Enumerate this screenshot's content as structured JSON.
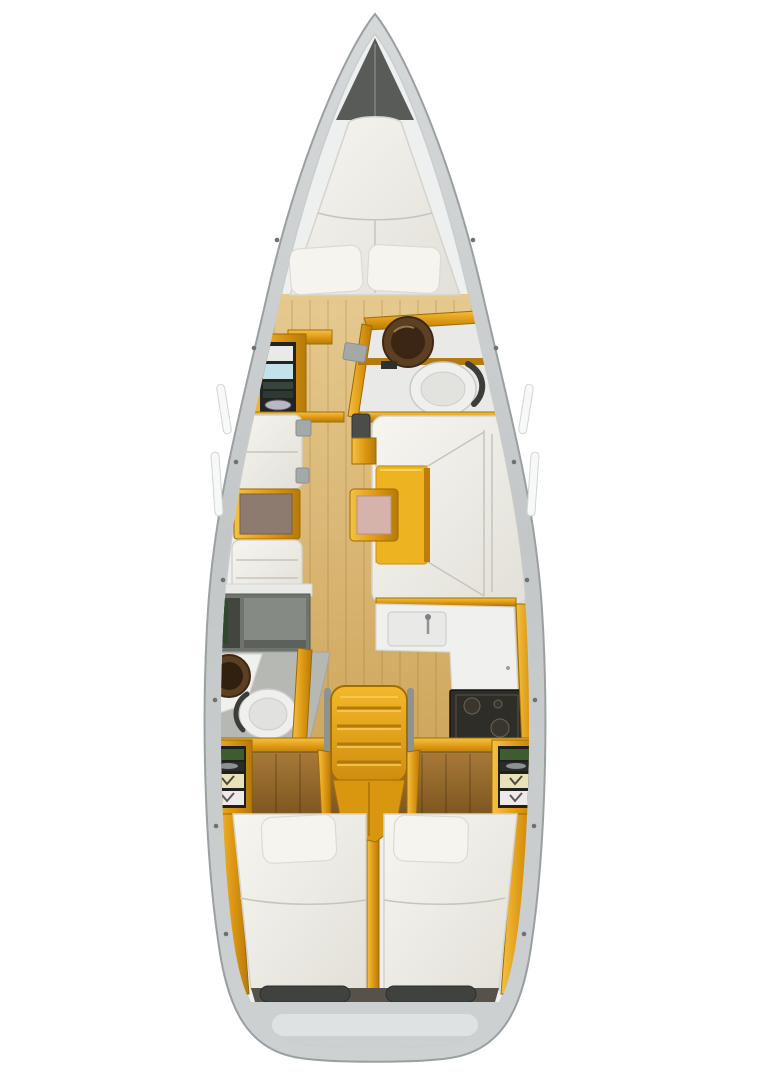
{
  "page": {
    "background": "#ffffff",
    "content_type": "sailing-yacht-interior-deck-plan",
    "view": "top-down"
  },
  "palette": {
    "background": "#ffffff",
    "hull_edge": "#9aa0a1",
    "hull_inner": "#eef0f0",
    "bow_shadow": "#585b58",
    "wood": "#e8a716",
    "wood_light": "#f3c340",
    "wood_dark": "#a36d08",
    "headboard_wood": "#96682a",
    "floor": "#d9b873",
    "cushion": "#f0eee7",
    "cushion_shadow": "#d5d3cb",
    "table_brown": "#8d7b70",
    "table_yellow": "#edb320",
    "stool_pink": "#d5b2aa",
    "counter_white": "#f0f1ef",
    "fixture_white": "#eff0ee",
    "sink_bronze": "#5d3f22",
    "stove_black": "#2e2d28",
    "shower_gray": "#70746f",
    "locker_dark": "#1e201c",
    "shelf_green": "#3e5c30",
    "shelf_cream": "#e9e1b9",
    "transom_gray": "#ccd0d0",
    "recess_dark": "#3f423f"
  },
  "plan": {
    "vessel": "monohull-sailing-yacht",
    "areas": [
      {
        "name": "bow",
        "fixtures": [
          "anchor-locker"
        ]
      },
      {
        "name": "forward-cabin",
        "fixtures": [
          "v-berth-double-mattress",
          "pillow-port",
          "pillow-starboard",
          "side-shelf-port",
          "side-shelf-starboard",
          "wardrobe-shelving-unit"
        ]
      },
      {
        "name": "forward-head",
        "fixtures": [
          "round-washbasin",
          "toilet",
          "vanity-counter"
        ]
      },
      {
        "name": "salon-port",
        "fixtures": [
          "forward-settee",
          "cocktail-table-brown-top",
          "aft-settee"
        ]
      },
      {
        "name": "salon-starboard",
        "fixtures": [
          "u-shaped-settee",
          "dining-table-yellow",
          "stool-pink-top",
          "side-cube-seat"
        ]
      },
      {
        "name": "galley-starboard",
        "fixtures": [
          "counter-l-shaped",
          "sink",
          "faucet",
          "refrigerator",
          "stove-oven"
        ]
      },
      {
        "name": "aft-head-port",
        "fixtures": [
          "shower-stall",
          "round-washbasin",
          "toilet",
          "vanity-counter"
        ]
      },
      {
        "name": "companionway",
        "fixtures": [
          "ladder-steps",
          "handrail-port",
          "handrail-starboard"
        ]
      },
      {
        "name": "aft-cabin-port",
        "fixtures": [
          "double-berth-mattress",
          "pillow",
          "headboard",
          "shelf-unit"
        ]
      },
      {
        "name": "aft-cabin-starboard",
        "fixtures": [
          "double-berth-mattress",
          "pillow",
          "headboard",
          "shelf-unit"
        ]
      },
      {
        "name": "stern",
        "fixtures": [
          "transom",
          "cockpit-recess-port",
          "cockpit-recess-starboard"
        ]
      }
    ]
  }
}
